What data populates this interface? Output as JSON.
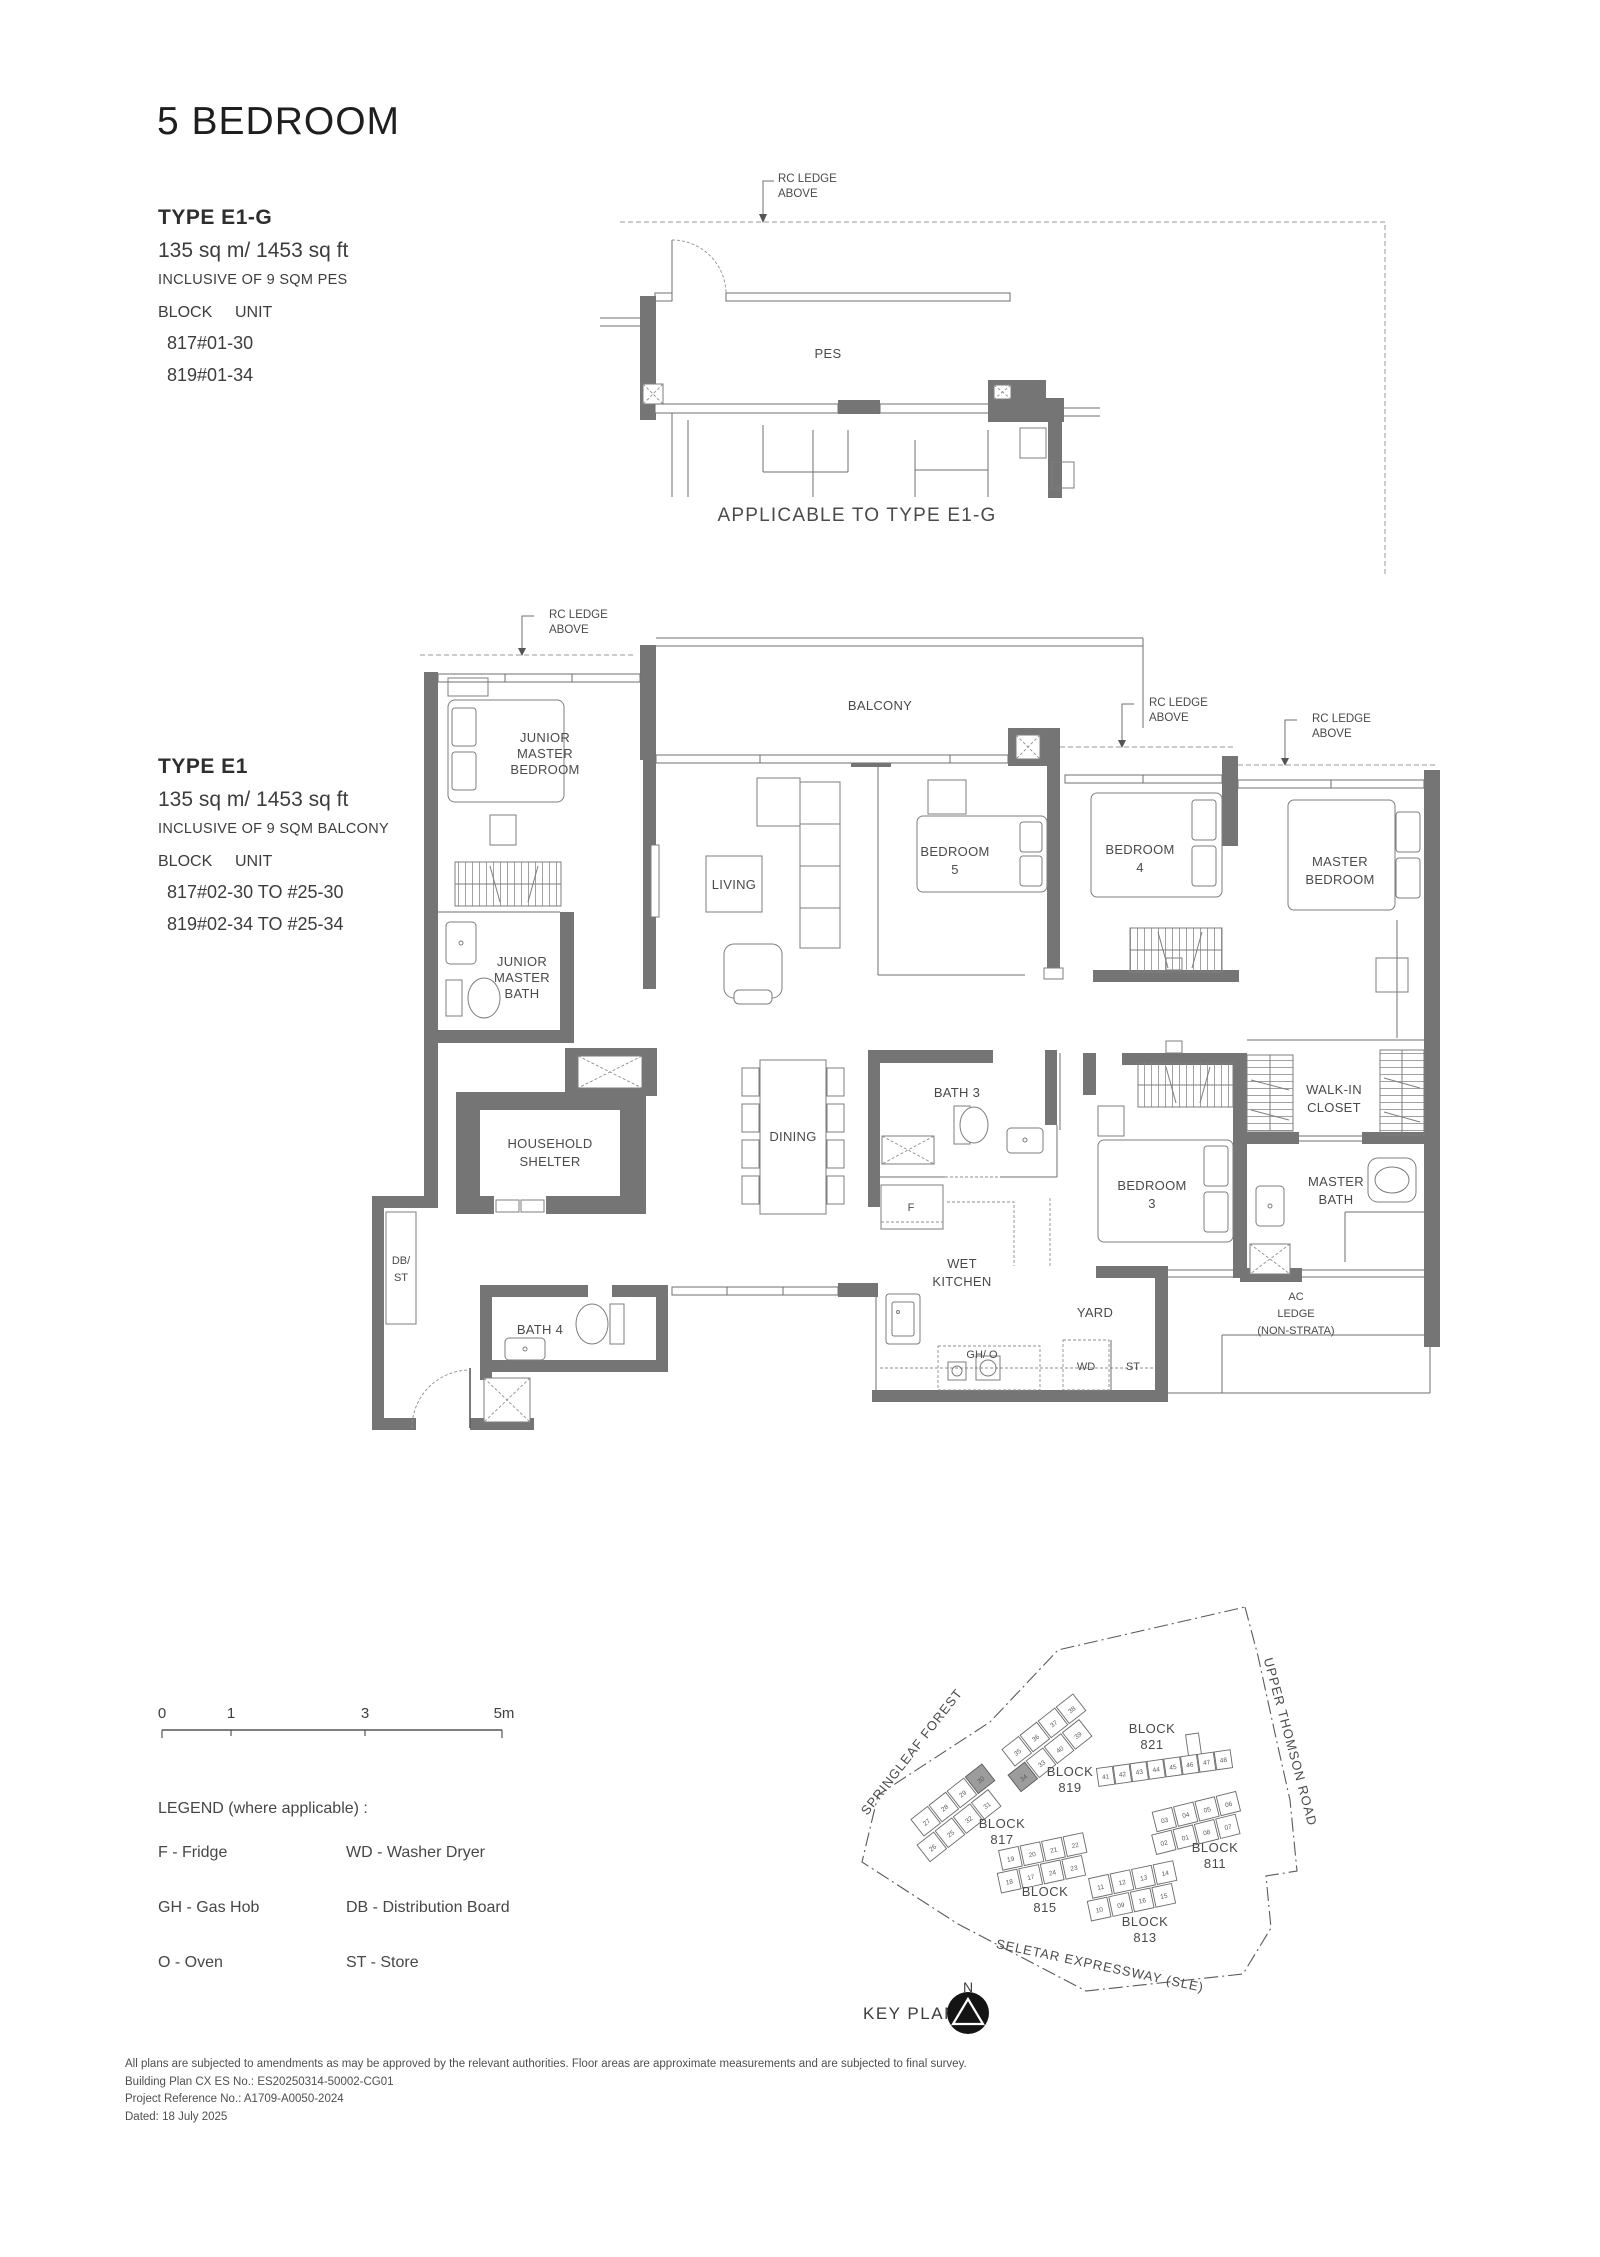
{
  "title": "5 BEDROOM",
  "type_e1g": {
    "name": "TYPE E1-G",
    "area": "135 sq m/ 1453 sq ft",
    "inclusive": "INCLUSIVE OF 9 SQM PES",
    "block_header": "BLOCK",
    "unit_header": "UNIT",
    "rows": [
      {
        "block": "817",
        "unit": "#01-30"
      },
      {
        "block": "819",
        "unit": "#01-34"
      }
    ],
    "caption": "APPLICABLE TO TYPE E1-G"
  },
  "type_e1": {
    "name": "TYPE E1",
    "area": "135 sq m/ 1453 sq ft",
    "inclusive": "INCLUSIVE OF 9 SQM BALCONY",
    "block_header": "BLOCK",
    "unit_header": "UNIT",
    "rows": [
      {
        "block": "817",
        "unit": "#02-30 TO #25-30"
      },
      {
        "block": "819",
        "unit": "#02-34 TO #25-34"
      }
    ]
  },
  "labels": {
    "rc_ledge": [
      "RC LEDGE",
      "ABOVE"
    ],
    "pes": "PES",
    "balcony": "BALCONY",
    "living": "LIVING",
    "dining": "DINING",
    "yard": "YARD",
    "wd": "WD",
    "st": "ST",
    "f": "F",
    "gh_o": "GH/ O",
    "bath3": "BATH 3",
    "bath4": "BATH 4",
    "junior_master_bedroom": [
      "JUNIOR",
      "MASTER",
      "BEDROOM"
    ],
    "junior_master_bath": [
      "JUNIOR",
      "MASTER",
      "BATH"
    ],
    "bedroom5": [
      "BEDROOM",
      "5"
    ],
    "bedroom4": [
      "BEDROOM",
      "4"
    ],
    "bedroom3": [
      "BEDROOM",
      "3"
    ],
    "master_bedroom": [
      "MASTER",
      "BEDROOM"
    ],
    "walk_in_closet": [
      "WALK-IN",
      "CLOSET"
    ],
    "master_bath": [
      "MASTER",
      "BATH"
    ],
    "household_shelter": [
      "HOUSEHOLD",
      "SHELTER"
    ],
    "wet_kitchen": [
      "WET",
      "KITCHEN"
    ],
    "db_st": [
      "DB/",
      "ST"
    ],
    "ac_ledge": [
      "AC",
      "LEDGE",
      "(NON-STRATA)"
    ]
  },
  "scale_bar": {
    "ticks": [
      "0",
      "1",
      "3",
      "5m"
    ]
  },
  "legend": {
    "title": "LEGEND (where applicable) :",
    "col1": [
      "F - Fridge",
      "GH - Gas Hob",
      "O - Oven"
    ],
    "col2": [
      "WD - Washer Dryer",
      "DB - Distribution Board",
      "ST - Store"
    ]
  },
  "key_plan": {
    "label": "KEY PLAN",
    "north": "N",
    "roads": {
      "springleaf": "SPRINGLEAF FOREST",
      "thomson": "UPPER THOMSON ROAD",
      "seletar": "SELETAR EXPRESSWAY (SLE)"
    },
    "block_word": "BLOCK",
    "blocks": {
      "b811": "811",
      "b813": "813",
      "b815": "815",
      "b817": "817",
      "b819": "819",
      "b821": "821"
    },
    "units": {
      "b819": [
        "35",
        "36",
        "37",
        "38",
        "34",
        "33",
        "40",
        "39"
      ],
      "b821": [
        "41",
        "42",
        "43",
        "44",
        "45",
        "46",
        "47",
        "48"
      ],
      "b817": [
        "27",
        "28",
        "29",
        "30",
        "26",
        "25",
        "32",
        "31"
      ],
      "b815": [
        "19",
        "20",
        "21",
        "22",
        "18",
        "17",
        "24",
        "23"
      ],
      "b813": [
        "11",
        "12",
        "13",
        "14",
        "10",
        "09",
        "16",
        "15"
      ],
      "b811": [
        "03",
        "04",
        "05",
        "06",
        "02",
        "01",
        "08",
        "07"
      ]
    }
  },
  "footer": [
    "All plans are subjected to amendments as may be approved by the relevant authorities. Floor areas are approximate measurements and are subjected to final survey.",
    "Building Plan CX ES No.: ES20250314-50002-CG01",
    "Project Reference No.: A1709-A0050-2024",
    "Dated: 18 July 2025"
  ],
  "colors": {
    "wall": "#757575",
    "line": "#6f6f6f",
    "text": "#3d3d3d",
    "highlight_unit": "#9c9c9c"
  }
}
